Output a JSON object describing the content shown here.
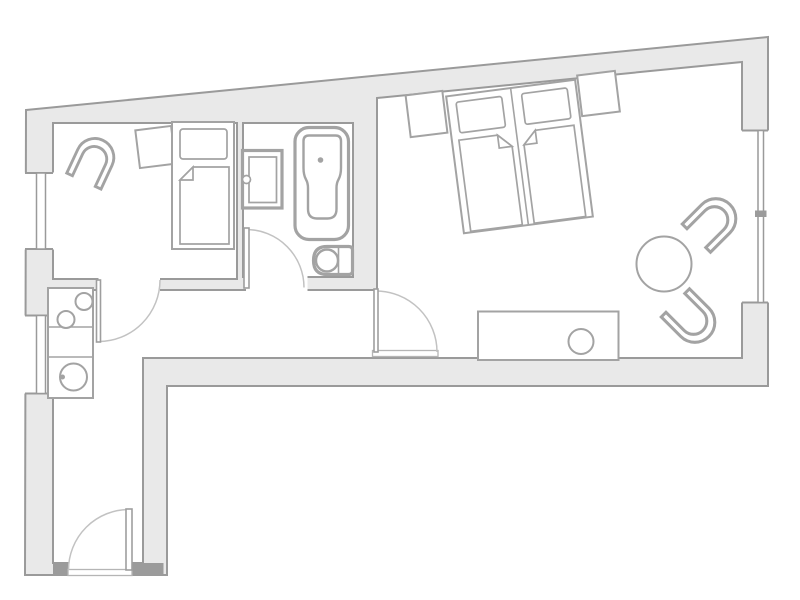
{
  "image_type": "architectural floor plan, top-down view, no text labels",
  "canvas": {
    "width": 800,
    "height": 600
  },
  "palette": {
    "background": "#ffffff",
    "wall_fill": "#e9e9e9",
    "wall_stroke": "#9a9a9a",
    "furniture_stroke": "#a3a3a3",
    "door_arc": "#c2c2c2",
    "jamb_fill": "#9b9b9b"
  },
  "outline": {
    "shape": "irregular polygon, slanted top wall rising left-to-right, hallway stub protruding at bottom-left",
    "outer_corners": [
      [
        26,
        110
      ],
      [
        768,
        37
      ],
      [
        768,
        386
      ],
      [
        167,
        386
      ],
      [
        167,
        575
      ],
      [
        25,
        575
      ]
    ]
  },
  "rooms": [
    {
      "id": "small-bedroom",
      "area_px": [
        53,
        123,
        237,
        279
      ],
      "fixtures": [
        "armchair",
        "side-table",
        "single-bed"
      ]
    },
    {
      "id": "bathroom",
      "area_px": [
        243,
        123,
        353,
        277
      ],
      "fixtures": [
        "vanity-sink",
        "bathtub",
        "toilet"
      ]
    },
    {
      "id": "main-bedroom",
      "area_px": [
        377,
        62,
        742,
        358
      ],
      "fixtures": [
        "double-bed",
        "nightstand-left",
        "nightstand-right",
        "sideboard",
        "round-table",
        "tub-chair-upper",
        "tub-chair-lower"
      ]
    },
    {
      "id": "kitchen-corridor",
      "area_px": [
        53,
        290,
        377,
        358
      ],
      "fixtures": [
        "kitchenette-counter",
        "burner-1",
        "burner-2",
        "round-sink"
      ]
    },
    {
      "id": "entrance-hallway",
      "area_px": [
        53,
        358,
        143,
        575
      ],
      "fixtures": []
    }
  ],
  "doors": [
    {
      "id": "entrance-door",
      "hinge": [
        129,
        570
      ],
      "radius": 60.5,
      "swing": "opens up-left into hallway",
      "threshold": [
        68,
        570,
        132,
        576
      ]
    },
    {
      "id": "small-bedroom-door",
      "hinge": [
        98.5,
        280
      ],
      "radius": 61.5,
      "swing": "opens down-right into corridor"
    },
    {
      "id": "bathroom-door",
      "hinge": [
        246.5,
        287.5
      ],
      "radius": 58,
      "swing": "opens up-right into bathroom"
    },
    {
      "id": "main-bedroom-door",
      "hinge": [
        376,
        352
      ],
      "radius": 61,
      "swing": "opens up-right into bedroom",
      "threshold": [
        372.5,
        350.5,
        438,
        356.5
      ]
    }
  ],
  "windows": [
    {
      "id": "window-left-upper",
      "wall": "west",
      "span_y": [
        173,
        249
      ],
      "lines_x": [
        36.5,
        45.5
      ]
    },
    {
      "id": "window-left-lower",
      "wall": "west",
      "span_y": [
        315,
        394
      ],
      "lines_x": [
        36.5,
        45.5
      ]
    },
    {
      "id": "window-right",
      "wall": "east",
      "span_y": [
        130,
        303
      ],
      "lines_x": [
        758,
        763.5
      ],
      "divider_y": [
        210.5,
        217
      ]
    }
  ],
  "furniture_geometry": {
    "armchair": {
      "center": [
        93,
        161.5
      ],
      "rotation_deg": 25,
      "type": "tub-chair"
    },
    "side-table": {
      "center": [
        155.5,
        147
      ],
      "size": [
        36,
        38
      ],
      "rotation_deg": -7
    },
    "single-bed": {
      "frame": [
        172,
        122,
        62,
        127
      ],
      "pillow": [
        180,
        129,
        47,
        30
      ],
      "mattress_fold": "top-left"
    },
    "double-bed": {
      "center": [
        519.5,
        156.5
      ],
      "size": [
        130,
        138
      ],
      "rotation_deg": -7.4,
      "halves": 2,
      "mattress_folds": "inner top corners"
    },
    "nightstand-left": {
      "center": [
        426.5,
        114
      ],
      "size": [
        37,
        42
      ],
      "rotation_deg": -7
    },
    "nightstand-right": {
      "center": [
        598.5,
        93.5
      ],
      "size": [
        38,
        41
      ],
      "rotation_deg": -7
    },
    "sideboard": {
      "rect": [
        478,
        311.5,
        140.5,
        48.5
      ],
      "knob_circle": [
        581,
        341.5,
        12.5
      ]
    },
    "round-table": {
      "center": [
        664,
        264
      ],
      "radius": 27.5
    },
    "tub-chair-upper": {
      "center": [
        712.5,
        222
      ],
      "rotation_deg": 45
    },
    "tub-chair-lower": {
      "center": [
        691.5,
        319
      ],
      "rotation_deg": 135
    },
    "kitchenette-counter": {
      "rect": [
        48,
        288,
        45,
        110
      ],
      "dividers_y": [
        327,
        357
      ],
      "burners": [
        [
          84,
          301.5,
          8.5
        ],
        [
          66,
          319.5,
          8.5
        ]
      ],
      "sink": [
        73.5,
        377,
        13.5
      ],
      "tap_dot": [
        62.5,
        377,
        2.5
      ]
    },
    "vanity-sink": {
      "outer": [
        242.5,
        150.5,
        39.5,
        57.5
      ],
      "inner": [
        249,
        157,
        27.5,
        45.5
      ],
      "knob": [
        246.5,
        179.5,
        4
      ]
    },
    "bathtub": {
      "outer": [
        295,
        127.5,
        53.5,
        112
      ],
      "corner_radius": 14,
      "drain_dot": [
        320.5,
        160,
        2.8
      ]
    },
    "toilet": {
      "body": [
        313.5,
        246.5,
        39,
        28
      ],
      "bowl": [
        327,
        260.5,
        11
      ],
      "tank_divider_x": 338.5
    }
  }
}
